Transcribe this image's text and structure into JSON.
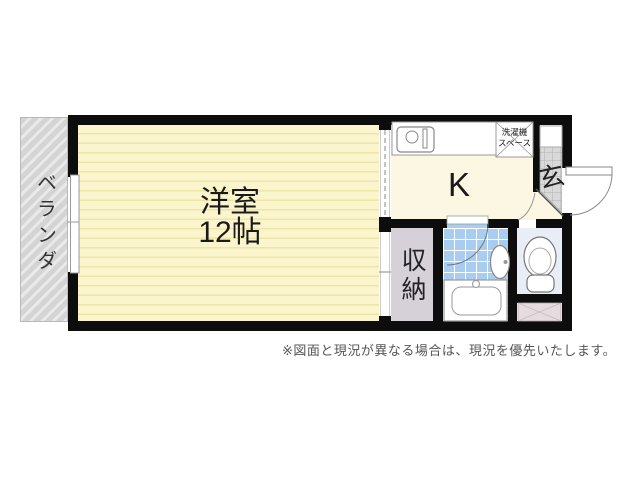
{
  "floor_plan": {
    "veranda": {
      "label": "ベランダ"
    },
    "main_room": {
      "name_label": "洋室",
      "size_label": "12帖"
    },
    "kitchen": {
      "label": "K"
    },
    "washer_space": {
      "line1": "洗濯機",
      "line2": "スペース"
    },
    "entrance": {
      "label": "玄"
    },
    "storage": {
      "label": "収納"
    }
  },
  "footnote": "※図面と現況が異なる場合は、現況を優先いたします。",
  "colors": {
    "wall": "#0d0d0d",
    "room_yellow": "#faf5cd",
    "room_stripe": "#efe5a6",
    "kitchen_cream": "#fbf7e3",
    "bath_tile_blue": "#a9cdf0",
    "toilet_bg": "#e9eef6",
    "storage_lavender": "#d6d0d9",
    "veranda_gray": "#d4d4d4",
    "entrance_tile_gray": "#d9d9d9",
    "pipe_space_pink": "#e6dce0"
  }
}
